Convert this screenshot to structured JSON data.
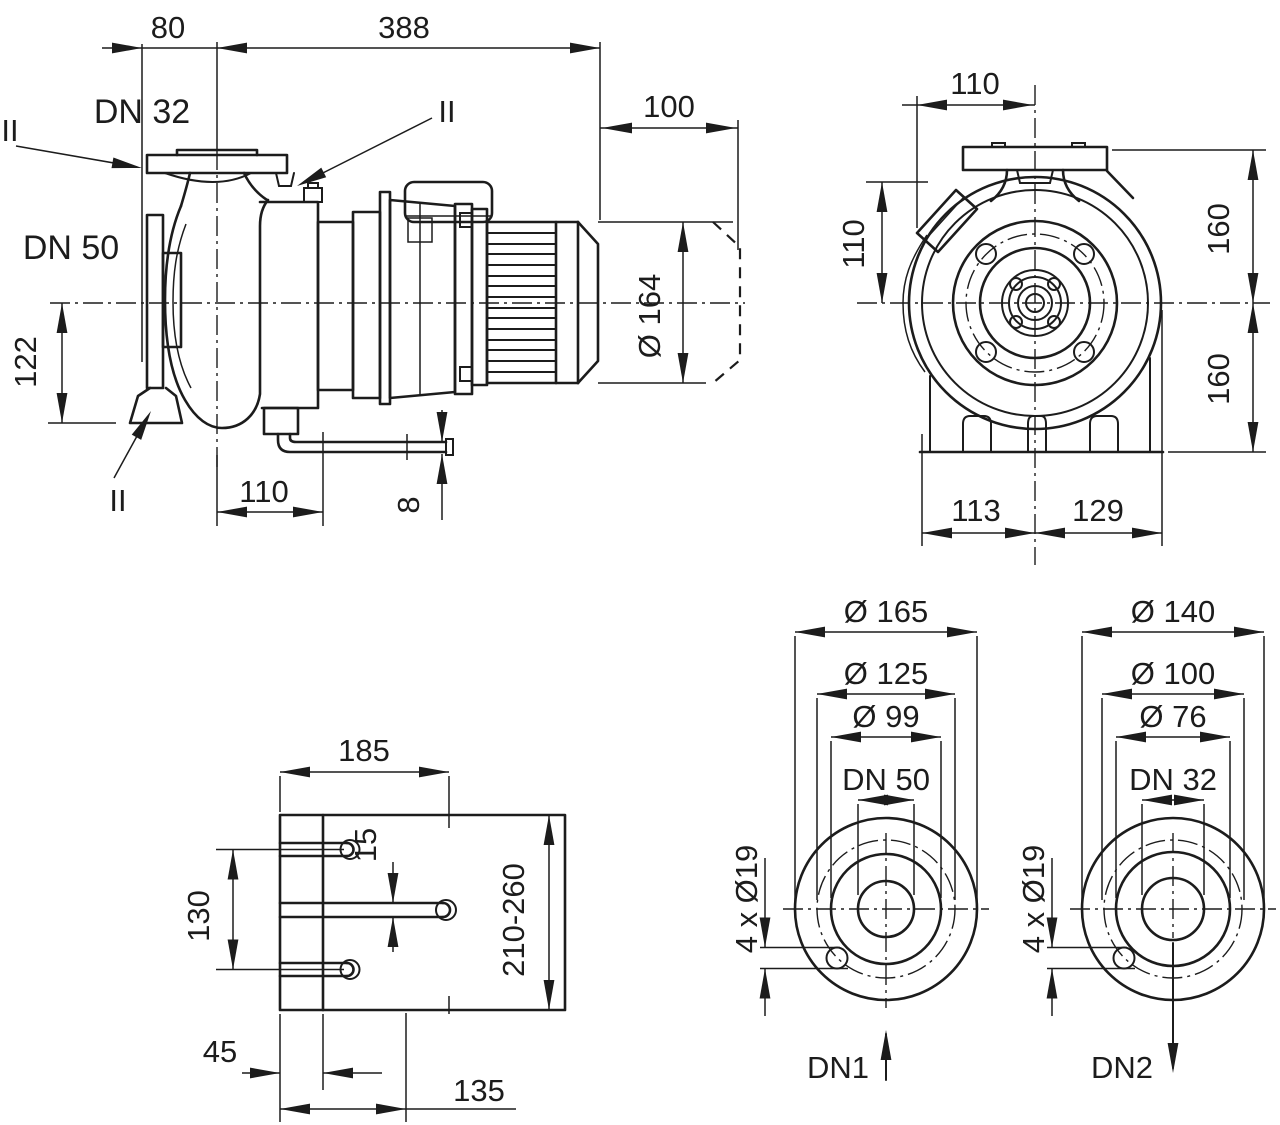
{
  "drawing": {
    "side_view": {
      "dim_flange_to_axis": "80",
      "dim_axis_to_motor_end": "388",
      "dim_motor_extension": "100",
      "dim_motor_diameter": "Ø 164",
      "label_discharge_port": "DN 32",
      "label_suction_port": "DN 50",
      "dim_axis_to_foot": "122",
      "dim_axis_to_drain": "110",
      "dim_drain_pipe": "8",
      "section_mark_top": "II",
      "section_mark_vent": "II",
      "section_mark_bottom": "II"
    },
    "front_view": {
      "dim_box_to_axis": "110",
      "dim_box_above_axis": "110",
      "dim_axis_to_flange_top": "160",
      "dim_axis_to_base": "160",
      "dim_base_left": "113",
      "dim_base_right": "129"
    },
    "base_plate_view": {
      "dim_width": "185",
      "dim_slot_width": "15",
      "dim_slot_spacing": "130",
      "dim_depth_range": "210-260",
      "dim_edge_offset": "45",
      "dim_bolt_offset": "135"
    },
    "flange_dn1": {
      "dia_outer": "Ø 165",
      "dia_bolt_circle": "Ø 125",
      "dia_face": "Ø 99",
      "nominal": "DN 50",
      "bolt_holes": "4 x Ø19",
      "port_label": "DN1"
    },
    "flange_dn2": {
      "dia_outer": "Ø 140",
      "dia_bolt_circle": "Ø 100",
      "dia_face": "Ø 76",
      "nominal": "DN 32",
      "bolt_holes": "4 x Ø19",
      "port_label": "DN2"
    }
  }
}
